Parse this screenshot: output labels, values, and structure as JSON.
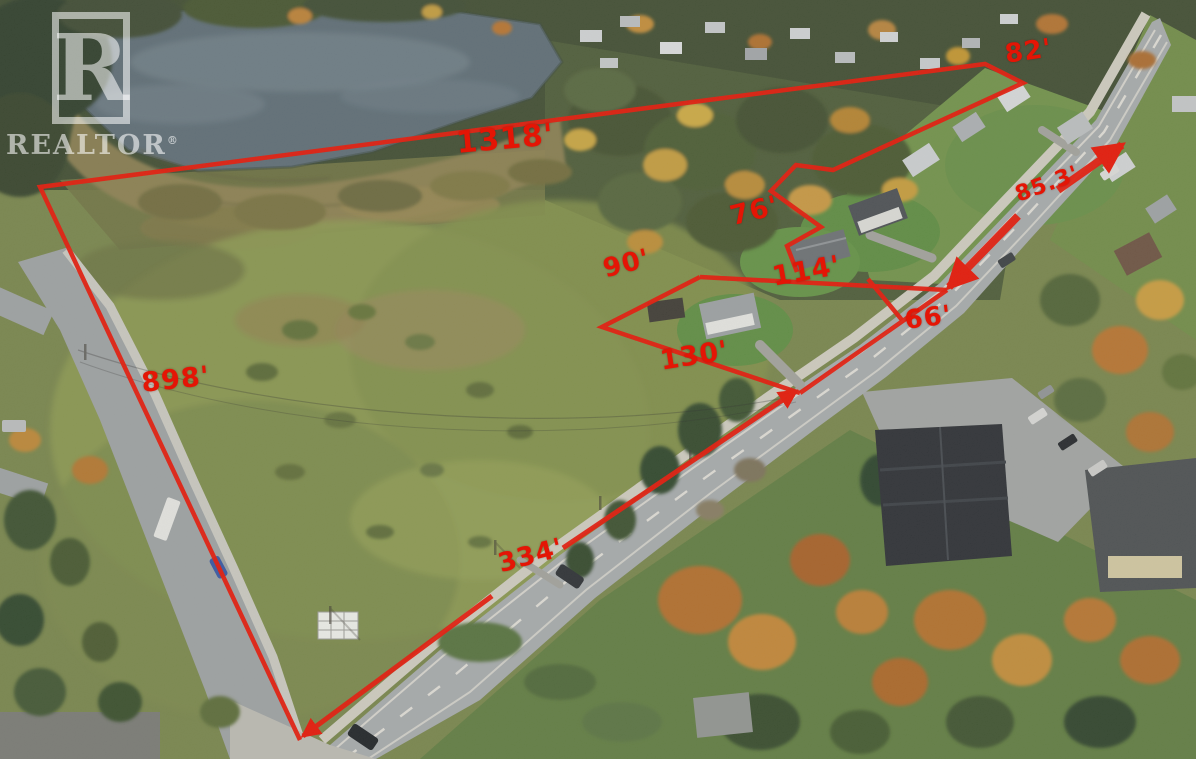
{
  "watermark": {
    "logo_letter": "R",
    "brand": "REALTOR",
    "registered_mark": "®"
  },
  "annotations": {
    "line_color": "#e41505",
    "measurements": [
      {
        "id": "top-boundary",
        "text": "1318'"
      },
      {
        "id": "northeast-corner",
        "text": "82'"
      },
      {
        "id": "notch-side",
        "text": "76'"
      },
      {
        "id": "inner-lot-north",
        "text": "114'"
      },
      {
        "id": "road-frontage-small",
        "text": "66'"
      },
      {
        "id": "road-frontage-upper",
        "text": "85.3'"
      },
      {
        "id": "inner-lot-west",
        "text": "90'"
      },
      {
        "id": "inner-lot-south",
        "text": "130'"
      },
      {
        "id": "west-boundary",
        "text": "898'"
      },
      {
        "id": "road-frontage-lower",
        "text": "334'"
      }
    ]
  }
}
